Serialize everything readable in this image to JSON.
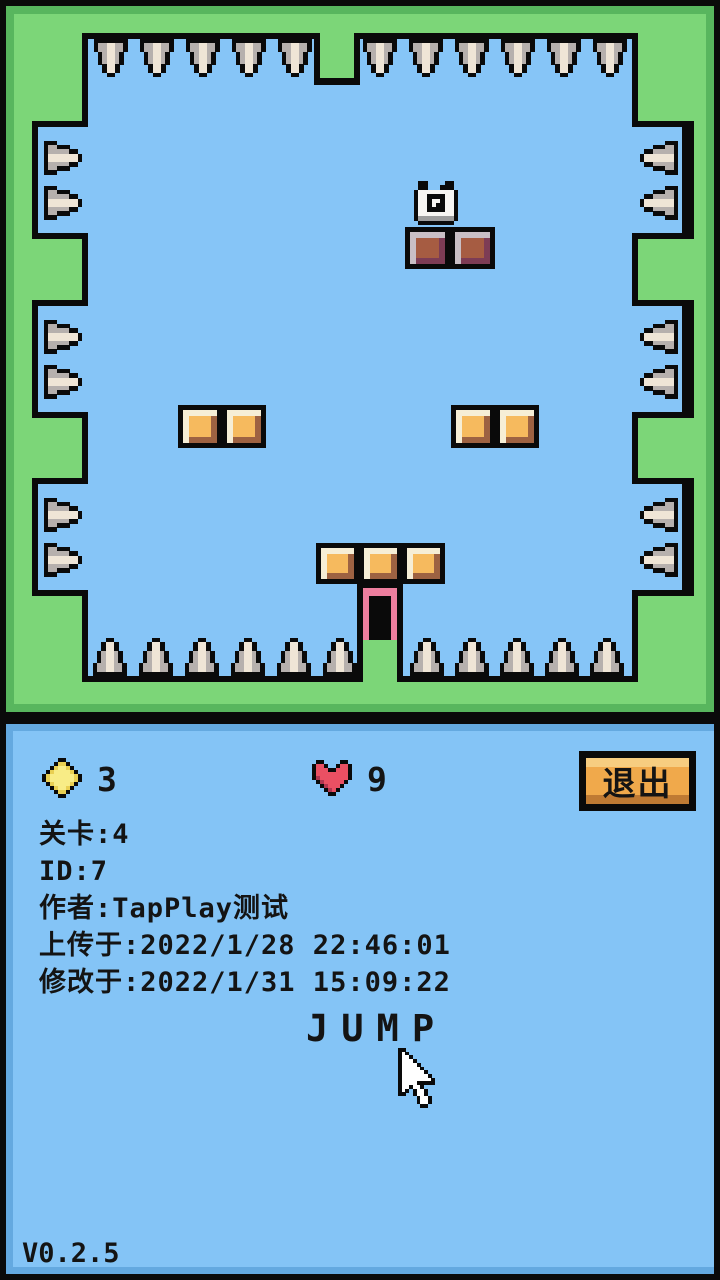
{
  "meta": {
    "version_label": "V0.2.5"
  },
  "hud": {
    "coins": "3",
    "lives": "9",
    "exit_label": "退出",
    "info_lines": [
      "关卡:4",
      "ID:7",
      "作者:TapPlay测试",
      "上传于:2022/1/28 22:46:01",
      "修改于:2022/1/31 15:09:22"
    ],
    "action_hint": "JUMP"
  },
  "colors": {
    "black": "#0a0a0a",
    "frame_green": "#7cd678",
    "frame_green_dark": "#58b65e",
    "sky_blue": "#86c5f7",
    "panel_blue": "#84c4f6",
    "panel_blue_dark": "#64a9e0",
    "door_pink": "#ee7f9f",
    "button_orange": "#f0a94b",
    "button_orange_light": "#f7cd80",
    "button_orange_dark": "#bf7a33"
  },
  "block_palettes": {
    "brown": {
      "outline": "#0a0a0a",
      "light": "#c9bfc5",
      "fill": "#a65c42",
      "dark": "#7d3c55"
    },
    "orange": {
      "outline": "#0a0a0a",
      "light": "#f6eed6",
      "fill": "#f6ba5e",
      "dark": "#9d6242"
    }
  },
  "level": {
    "frame_bevel": [
      6,
      6,
      708,
      706
    ],
    "frame_fill": [
      14,
      14,
      692,
      690
    ],
    "playfield_black": [
      82,
      33,
      556,
      649
    ],
    "playfield_blue": [
      88,
      39,
      544,
      637
    ],
    "niche": {
      "w": 50,
      "h": 106,
      "left_x": 38,
      "right_x": 632,
      "border": 6
    },
    "niche_ys": [
      127,
      306,
      484
    ],
    "top_notch_black": [
      314,
      33,
      46,
      52
    ],
    "top_notch_green": [
      320,
      33,
      34,
      45
    ],
    "spikes_top": {
      "y": 39,
      "xs": [
        94,
        140,
        186,
        232,
        278,
        363,
        409,
        455,
        501,
        547,
        593
      ]
    },
    "spikes_bottom": {
      "y": 638,
      "xs": [
        93,
        139,
        185,
        231,
        277,
        323,
        410,
        455,
        500,
        545,
        590
      ]
    },
    "spikes_left": {
      "x": 44,
      "ys": [
        141,
        186,
        320,
        365,
        498,
        543
      ]
    },
    "spikes_right": {
      "x": 640,
      "ys": [
        141,
        186,
        320,
        365,
        498,
        543
      ]
    },
    "blocks": [
      [
        405,
        227,
        45,
        42,
        "brown"
      ],
      [
        450,
        227,
        45,
        42,
        "brown"
      ],
      [
        178,
        405,
        44,
        43,
        "orange"
      ],
      [
        222,
        405,
        44,
        43,
        "orange"
      ],
      [
        451,
        405,
        44,
        43,
        "orange"
      ],
      [
        495,
        405,
        44,
        43,
        "orange"
      ],
      [
        316,
        543,
        43,
        41,
        "orange"
      ],
      [
        359,
        543,
        43,
        41,
        "orange"
      ],
      [
        402,
        543,
        43,
        41,
        "orange"
      ]
    ],
    "door": {
      "x": 357,
      "y": 582
    },
    "player": {
      "x": 414,
      "y": 181
    }
  },
  "sprites": {
    "spike-icon": {
      "px": 4.2,
      "palette": {
        "B": "#0a0a0a",
        "G": "#b6b0ad",
        "W": "#efe5d6"
      },
      "map": [
        "BBBBBBBB",
        "BGGWWGGB",
        "BGGWWGGB",
        ".BGWWGB.",
        ".BGWWGB.",
        ".BGWWGB.",
        "..BWWB..",
        "..BWWB..",
        "...BB..."
      ]
    },
    "coin-icon": {
      "px": 4,
      "palette": {
        "B": "#0a0a0a",
        "Y": "#e9cf52",
        "L": "#f8ec86"
      },
      "map": [
        "....BB....",
        "...BYYB...",
        "..BYLLYB..",
        ".BYLLLLYB.",
        "BYLLLLLLYB",
        "BYLLLLLLYB",
        ".BYLLLLYB.",
        "..BYLLYB..",
        "...BYYB...",
        "....BB...."
      ]
    },
    "heart-icon": {
      "px": 4,
      "palette": {
        "B": "#0a0a0a",
        "R": "#ea5063",
        "D": "#b03550"
      },
      "map": [
        ".BB....BB.",
        "BRRB..BRRB",
        "BRRRBBRRRB",
        "BRRRRRRRRB",
        "BDRRRRRRRB",
        ".BDRRRRRB.",
        "..BDRRRB..",
        "...BDRB...",
        "....BB...."
      ]
    },
    "player-sprite": {
      "px": 4.4,
      "palette": {
        "B": "#0a0a0a",
        "W": "#f7f5f2",
        "G": "#9c9c9c"
      },
      "map": [
        ".BB....BB..",
        ".BB...BBB..",
        "BWWWWWWWWB.",
        "BWWBBBBWWB.",
        "BWWBWWBWWB.",
        "BWWBWBBWWB.",
        "BWWBBBBWWB.",
        "BWWWWWWWWB.",
        "BGGGGGGGGB.",
        ".BBBBBBBB.."
      ]
    },
    "cursor-icon": {
      "px": 3.7,
      "palette": {
        "B": "#0a0a0a",
        "W": "#ffffff"
      },
      "map": [
        "BB...........",
        "BWB..........",
        "BWWB.........",
        "BWWWB........",
        "BWWWWB.......",
        "BWWWWWB......",
        "BWWWWWWB.....",
        "BWWWWWWWB....",
        "BWWWWWWWWB...",
        "BWWWWBBBBB...",
        "BWWBWWB......",
        "BWB.BWWB.....",
        "BB..BWWB.....",
        ".....BWWB....",
        ".....BWWB....",
        "......BB....."
      ]
    }
  }
}
